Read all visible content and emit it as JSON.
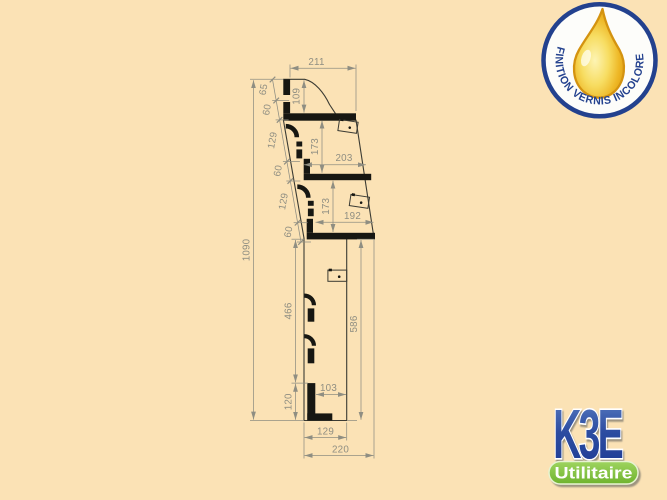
{
  "page": {
    "background": "#fbe2b5"
  },
  "drawing": {
    "dims": {
      "top_width": "211",
      "top_curve_height": "109",
      "left_chain": [
        "65",
        "60",
        "129",
        "60",
        "129",
        "60"
      ],
      "overall_height": "1090",
      "bay1_clear_height": "173",
      "bay1_depth": "203",
      "bay2_clear_height": "173",
      "bay2_depth": "192",
      "lower_front_height": "466",
      "lower_back_height": "586",
      "foot_height": "120",
      "foot_clear_width": "103",
      "body_depth": "129",
      "overall_depth": "220"
    }
  },
  "badge": {
    "label": "FINITION VERNIS INCOLORE"
  },
  "logo": {
    "brand": "K3E",
    "tagline": "Utilitaire"
  },
  "colors": {
    "background": "#fbe2b5",
    "profile_line": "#3b3b33",
    "profile_fill": "#171712",
    "dimension": "#8f8e82",
    "navy": "#23418e",
    "drop_gold": "#eeb827",
    "brand_blue": "#2d4da1",
    "brand_green": "#86c53e"
  }
}
